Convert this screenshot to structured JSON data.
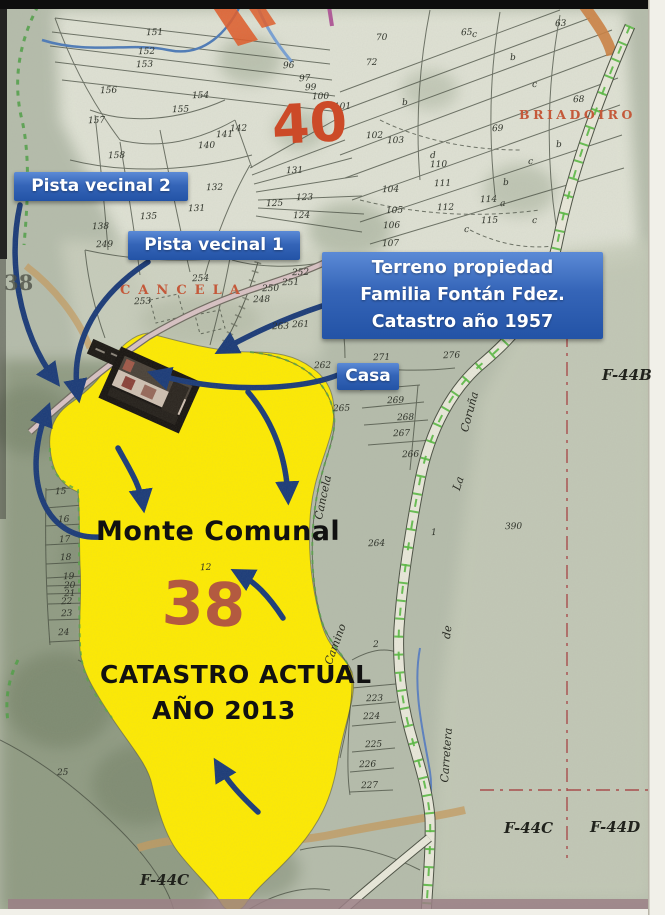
{
  "annotations": {
    "pista_vecinal_2": "Pista vecinal 2",
    "pista_vecinal_1": "Pista vecinal 1",
    "terreno_lines": [
      "Terreno propiedad",
      "Familia Fontán Fdez.",
      "Catastro año 1957"
    ],
    "casa": "Casa",
    "monte_comunal": "Monte Comunal",
    "catastro_actual": "CATASTRO ACTUAL",
    "ano_2013": "AÑO 2013"
  },
  "map": {
    "polygon_40": "40",
    "polygon_38": "38",
    "margin_38": "38",
    "place_cancela": "CANCELA",
    "place_briadoiro": "BRIADOIRO",
    "sheet_f44b": "F-44B",
    "sheet_f44c": "F-44C",
    "sheet_f44d": "F-44D",
    "sheet_f44c_bottom": "F-44C",
    "road": {
      "carretera": "Carretera",
      "de": "de",
      "la": "La",
      "coruna": "Coruña",
      "camino": "Camino",
      "cancela": "Cancela"
    },
    "parcels": [
      {
        "t": "151",
        "x": 146,
        "y": 28
      },
      {
        "t": "152",
        "x": 138,
        "y": 47
      },
      {
        "t": "153",
        "x": 136,
        "y": 60
      },
      {
        "t": "156",
        "x": 100,
        "y": 86
      },
      {
        "t": "154",
        "x": 192,
        "y": 91
      },
      {
        "t": "155",
        "x": 172,
        "y": 105
      },
      {
        "t": "157",
        "x": 88,
        "y": 116
      },
      {
        "t": "158",
        "x": 108,
        "y": 151
      },
      {
        "t": "140",
        "x": 198,
        "y": 141
      },
      {
        "t": "141",
        "x": 216,
        "y": 130
      },
      {
        "t": "142",
        "x": 230,
        "y": 124
      },
      {
        "t": "96",
        "x": 283,
        "y": 61
      },
      {
        "t": "97",
        "x": 299,
        "y": 74
      },
      {
        "t": "99",
        "x": 305,
        "y": 83
      },
      {
        "t": "100",
        "x": 312,
        "y": 92
      },
      {
        "t": "131",
        "x": 286,
        "y": 166
      },
      {
        "t": "132",
        "x": 206,
        "y": 183
      },
      {
        "t": "131",
        "x": 188,
        "y": 204
      },
      {
        "t": "135",
        "x": 140,
        "y": 212
      },
      {
        "t": "138",
        "x": 92,
        "y": 222
      },
      {
        "t": "125",
        "x": 266,
        "y": 199
      },
      {
        "t": "123",
        "x": 296,
        "y": 193
      },
      {
        "t": "124",
        "x": 293,
        "y": 211
      },
      {
        "t": "70",
        "x": 376,
        "y": 33
      },
      {
        "t": "72",
        "x": 366,
        "y": 58
      },
      {
        "t": "101",
        "x": 334,
        "y": 102
      },
      {
        "t": "102",
        "x": 366,
        "y": 131
      },
      {
        "t": "103",
        "x": 387,
        "y": 136
      },
      {
        "t": "104",
        "x": 382,
        "y": 185
      },
      {
        "t": "105",
        "x": 386,
        "y": 206
      },
      {
        "t": "106",
        "x": 383,
        "y": 221
      },
      {
        "t": "107",
        "x": 382,
        "y": 239
      },
      {
        "t": "110",
        "x": 430,
        "y": 160
      },
      {
        "t": "111",
        "x": 434,
        "y": 179
      },
      {
        "t": "112",
        "x": 437,
        "y": 203
      },
      {
        "t": "114",
        "x": 480,
        "y": 195
      },
      {
        "t": "115",
        "x": 481,
        "y": 216
      },
      {
        "t": "65",
        "x": 461,
        "y": 28
      },
      {
        "t": "63",
        "x": 555,
        "y": 19
      },
      {
        "t": "68",
        "x": 573,
        "y": 95
      },
      {
        "t": "69",
        "x": 492,
        "y": 124
      },
      {
        "t": "c",
        "x": 472,
        "y": 30
      },
      {
        "t": "b",
        "x": 510,
        "y": 53
      },
      {
        "t": "c",
        "x": 532,
        "y": 80
      },
      {
        "t": "b",
        "x": 402,
        "y": 98
      },
      {
        "t": "d",
        "x": 430,
        "y": 151
      },
      {
        "t": "b",
        "x": 556,
        "y": 140
      },
      {
        "t": "c",
        "x": 528,
        "y": 157
      },
      {
        "t": "b",
        "x": 503,
        "y": 178
      },
      {
        "t": "c",
        "x": 532,
        "y": 216
      },
      {
        "t": "c",
        "x": 464,
        "y": 225
      },
      {
        "t": "a",
        "x": 500,
        "y": 199
      },
      {
        "t": "249",
        "x": 96,
        "y": 240
      },
      {
        "t": "253",
        "x": 134,
        "y": 297
      },
      {
        "t": "254",
        "x": 192,
        "y": 274
      },
      {
        "t": "250",
        "x": 262,
        "y": 284
      },
      {
        "t": "251",
        "x": 282,
        "y": 278
      },
      {
        "t": "252",
        "x": 292,
        "y": 268
      },
      {
        "t": "248",
        "x": 253,
        "y": 295
      },
      {
        "t": "261",
        "x": 292,
        "y": 320
      },
      {
        "t": "263",
        "x": 272,
        "y": 322
      },
      {
        "t": "262",
        "x": 314,
        "y": 361
      },
      {
        "t": "271",
        "x": 373,
        "y": 353
      },
      {
        "t": "276",
        "x": 443,
        "y": 351
      },
      {
        "t": "269",
        "x": 387,
        "y": 396
      },
      {
        "t": "268",
        "x": 397,
        "y": 413
      },
      {
        "t": "267",
        "x": 393,
        "y": 429
      },
      {
        "t": "266",
        "x": 402,
        "y": 450
      },
      {
        "t": "265",
        "x": 333,
        "y": 404
      },
      {
        "t": "264",
        "x": 368,
        "y": 539
      },
      {
        "t": "390",
        "x": 505,
        "y": 522
      },
      {
        "t": "1",
        "x": 431,
        "y": 528
      },
      {
        "t": "12",
        "x": 200,
        "y": 563
      },
      {
        "t": "15",
        "x": 55,
        "y": 487
      },
      {
        "t": "16",
        "x": 58,
        "y": 515
      },
      {
        "t": "17",
        "x": 59,
        "y": 535
      },
      {
        "t": "18",
        "x": 60,
        "y": 553
      },
      {
        "t": "19",
        "x": 63,
        "y": 572
      },
      {
        "t": "20",
        "x": 64,
        "y": 581
      },
      {
        "t": "21",
        "x": 64,
        "y": 589
      },
      {
        "t": "22",
        "x": 61,
        "y": 597
      },
      {
        "t": "23",
        "x": 61,
        "y": 609
      },
      {
        "t": "24",
        "x": 58,
        "y": 628
      },
      {
        "t": "2",
        "x": 373,
        "y": 640
      },
      {
        "t": "223",
        "x": 366,
        "y": 694
      },
      {
        "t": "224",
        "x": 363,
        "y": 712
      },
      {
        "t": "225",
        "x": 365,
        "y": 740
      },
      {
        "t": "226",
        "x": 359,
        "y": 760
      },
      {
        "t": "227",
        "x": 361,
        "y": 781
      },
      {
        "t": "25",
        "x": 57,
        "y": 768
      }
    ]
  },
  "colors": {
    "blue_box": "#2f5cad",
    "arrow_blue": "#1a3a78",
    "highlight_yellow": "#ffeb00",
    "red_number_40": "#cc4a28",
    "red_number_38": "#b35a40",
    "place_red": "#c4593a",
    "grid_red": "#a84848",
    "road_cross_green": "#54b83c",
    "map_base": "#b5bcab"
  }
}
